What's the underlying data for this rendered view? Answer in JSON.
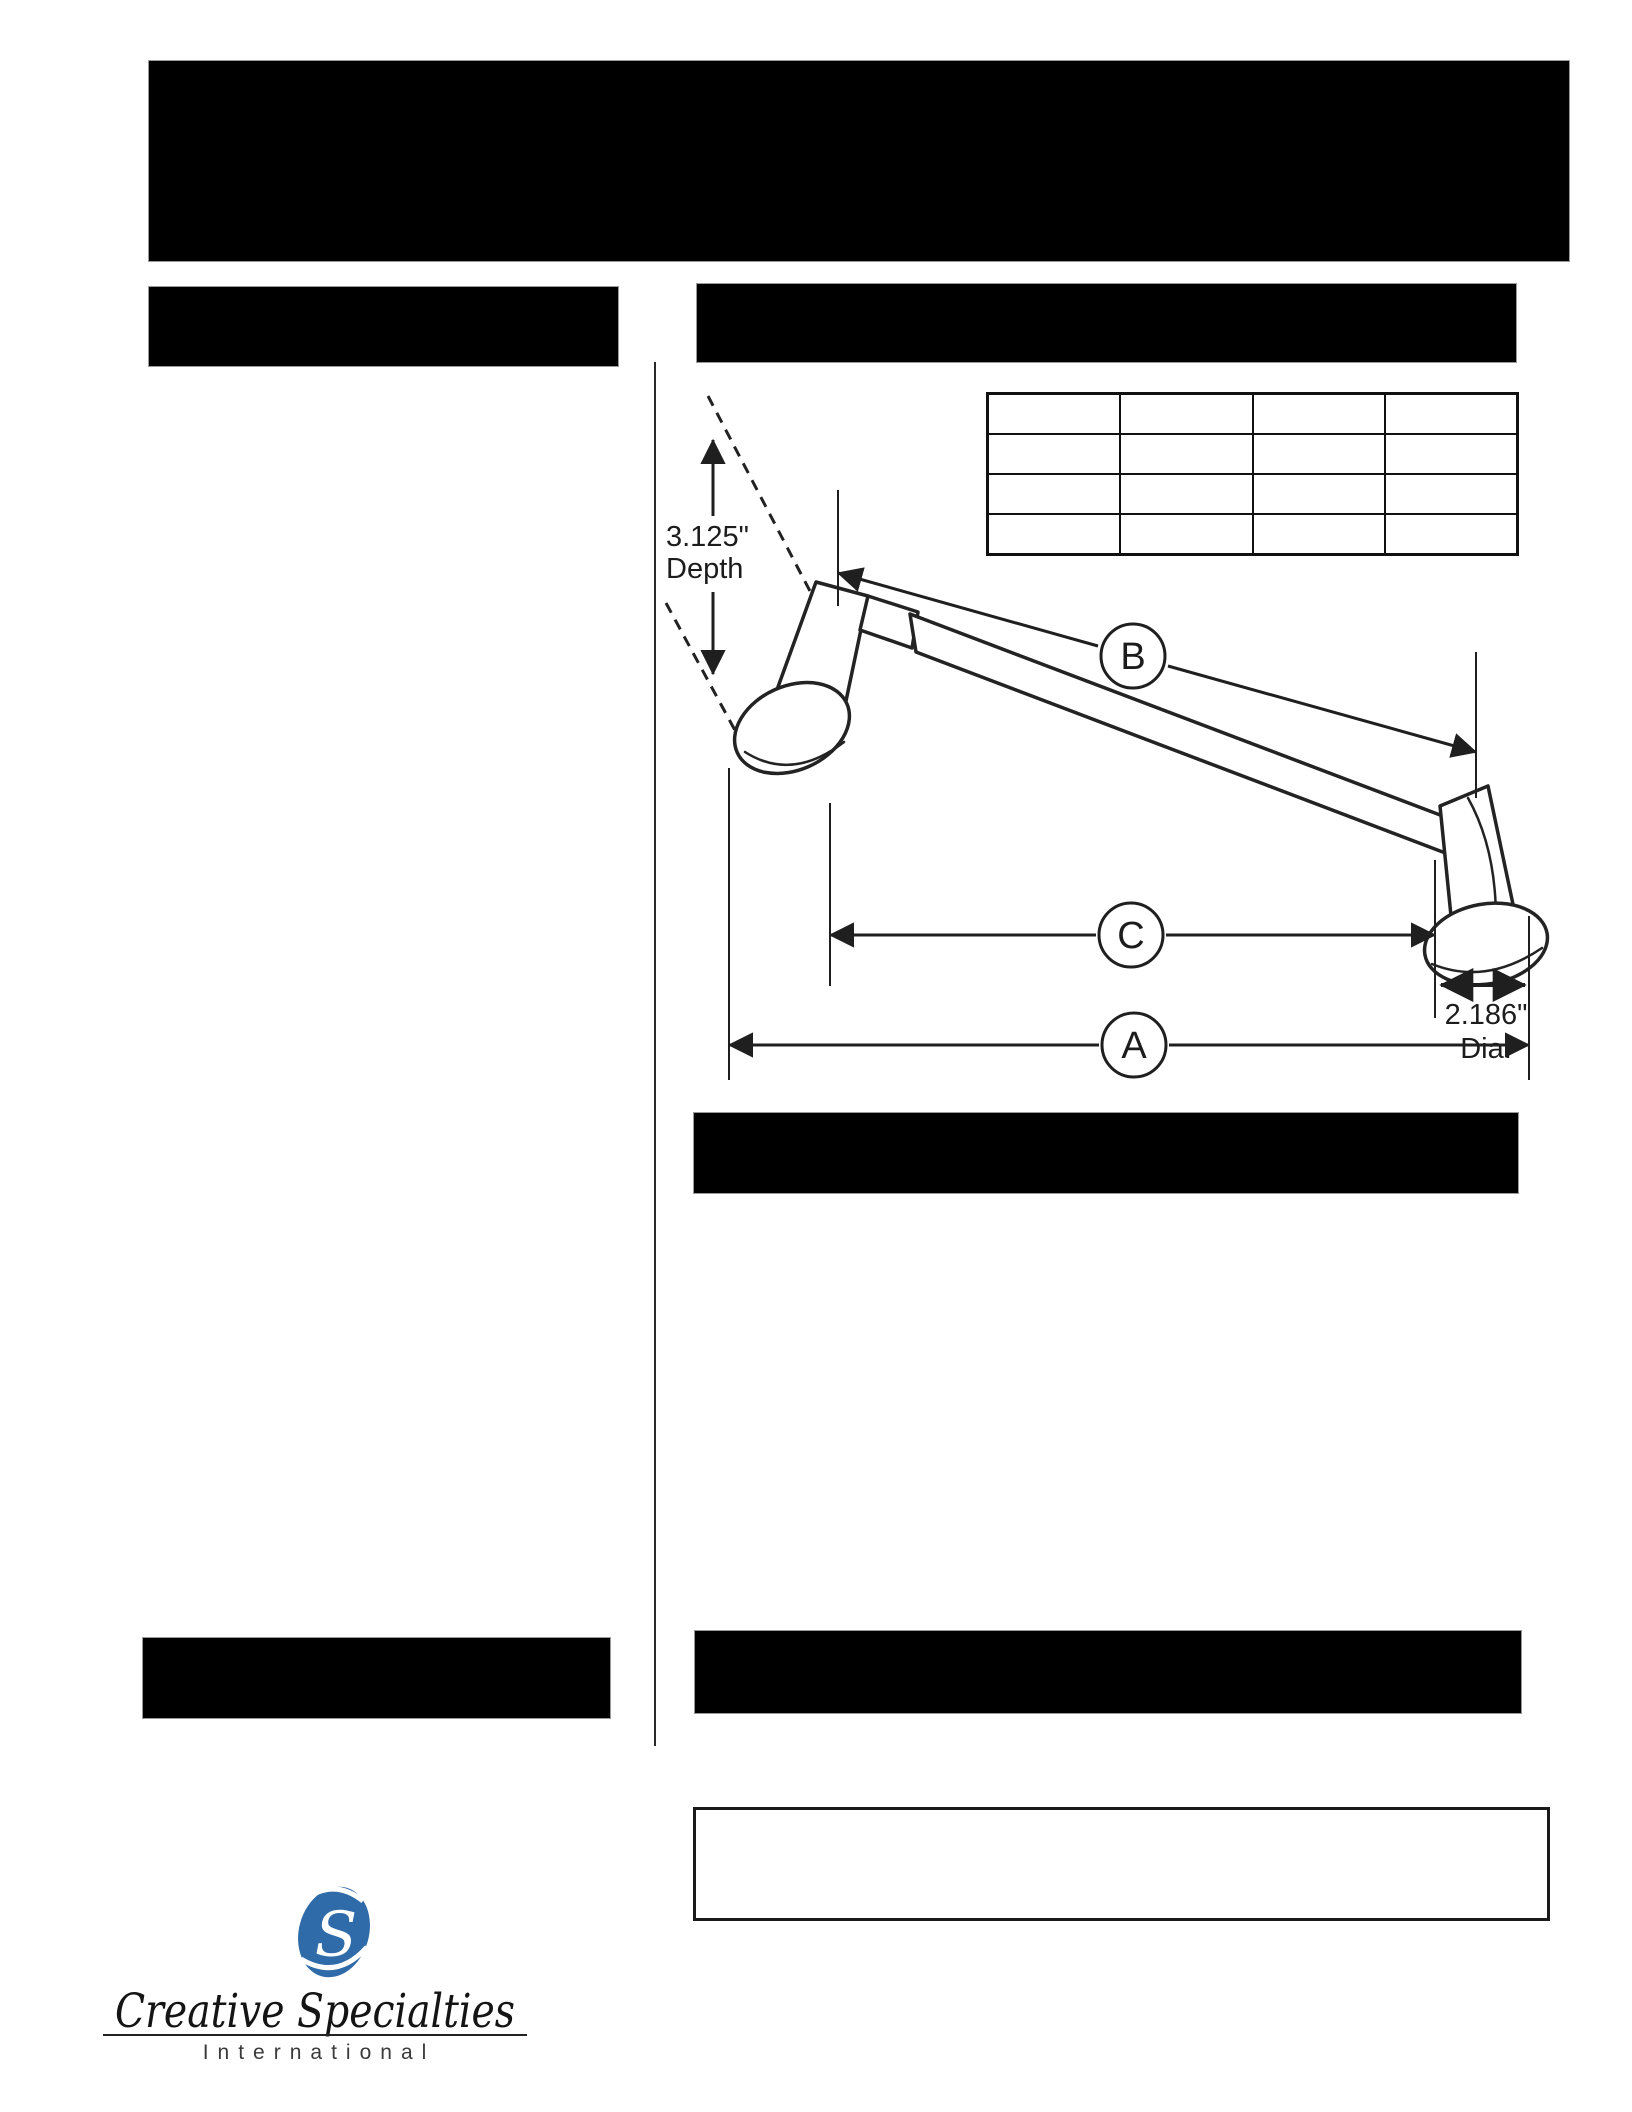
{
  "palette": {
    "page_bg": "#ffffff",
    "redaction_black": "#000000",
    "line_color": "#1f1f1f",
    "logo_blue": "#2e6ba8"
  },
  "diagram": {
    "depth_dim": {
      "value": "3.125\"",
      "label": "Depth"
    },
    "dim_b": "B",
    "dim_c": "C",
    "dim_a": "A",
    "diameter_dim": {
      "value": "2.186\"",
      "label": "Dia."
    },
    "spec_table": {
      "rows": 4,
      "columns": 4,
      "cells": [
        [
          "",
          "",
          "",
          ""
        ],
        [
          "",
          "",
          "",
          ""
        ],
        [
          "",
          "",
          "",
          ""
        ],
        [
          "",
          "",
          "",
          ""
        ]
      ]
    }
  },
  "logo": {
    "monogram": "S",
    "company_name": "Creative Specialties",
    "tagline": "International"
  }
}
